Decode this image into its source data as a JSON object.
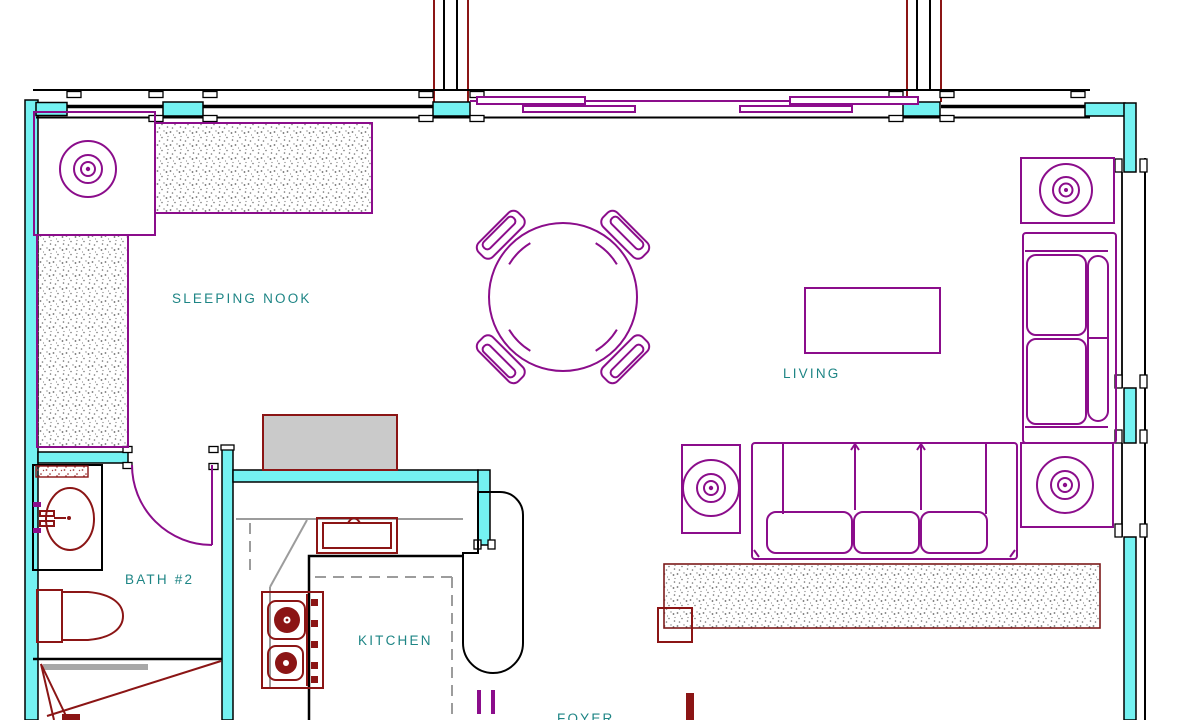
{
  "colors": {
    "wall_fill": "#74f2f2",
    "furniture": "#8b0d8b",
    "fixture": "#8b1515",
    "deck_line": "#7c1a1a",
    "label": "#1e8585",
    "counter_gray": "#9c9c9c",
    "fill_gray": "#cacaca",
    "capsule_fill": "#f0f0f0",
    "bar_gray": "#a8a8a8"
  },
  "rooms": {
    "sleeping_nook": {
      "label": "SLEEPING NOOK"
    },
    "living": {
      "label": "LIVING"
    },
    "bath2": {
      "label": "BATH #2"
    },
    "kitchen": {
      "label": "KITCHEN"
    },
    "foyer": {
      "label": "FOYER"
    }
  },
  "furniture": {
    "dining_table": "round dining table with 4 chairs",
    "sofa": "three-seat sofa",
    "loveseat": "two-seat loveseat",
    "coffee_table": "coffee table",
    "end_tables_with_lamps": 4,
    "beds": "two mattresses in sleeping nook",
    "bath_fixtures": "vanity sink, toilet",
    "kitchen_fixtures": "sink, range with two burners, eating bar"
  }
}
